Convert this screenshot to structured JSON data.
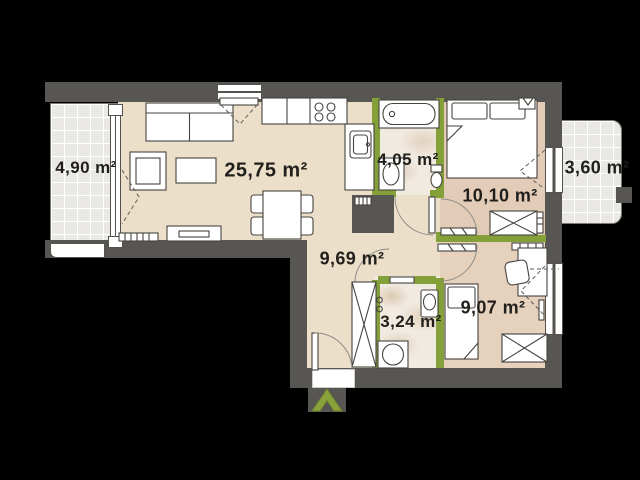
{
  "plan": {
    "title": "apartment-floor-plan",
    "colors": {
      "background": "#000000",
      "wall": "#585653",
      "partition": "#84a039",
      "floor_main": "#ebdfca",
      "floor_bedroom1": "#e3ccb7",
      "floor_bedroom2": "#e6d1bd",
      "floor_wet": "#f1eae1",
      "balcony": "#e9e8e5",
      "outline": "#45433f",
      "label": "#211f1b",
      "arrow": "#8aa23c"
    }
  },
  "rooms": [
    {
      "id": "balcony-left",
      "area_label": "4,90 m²"
    },
    {
      "id": "living-room",
      "area_label": "25,75 m²"
    },
    {
      "id": "bathroom",
      "area_label": "4,05 m²"
    },
    {
      "id": "bedroom-1",
      "area_label": "10,10 m²"
    },
    {
      "id": "balcony-right",
      "area_label": "3,60 m²"
    },
    {
      "id": "hallway",
      "area_label": "9,69 m²"
    },
    {
      "id": "wc",
      "area_label": "3,24 m²"
    },
    {
      "id": "bedroom-2",
      "area_label": "9,07 m²"
    }
  ]
}
